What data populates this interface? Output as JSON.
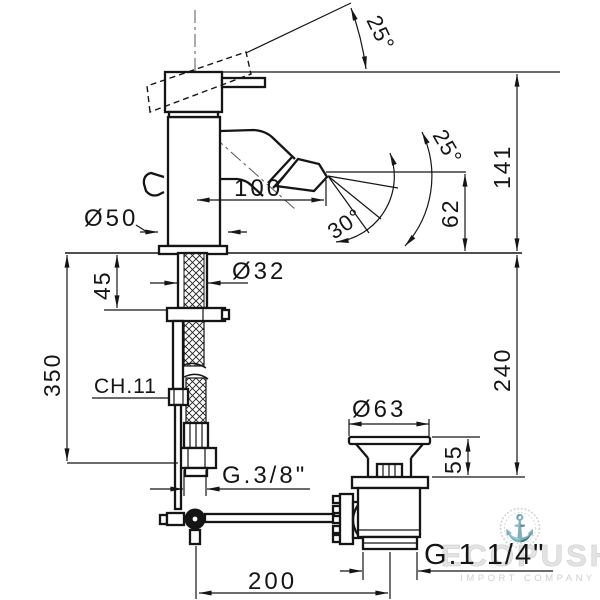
{
  "meta": {
    "background": "#ffffff",
    "ink_color": "#151515",
    "watermark_color": "#d8d8d8",
    "drawing_type": "bidet-mixer-dimensional-drawing"
  },
  "labels": {
    "handle_angle": "25°",
    "spout_height": "141",
    "spray_upper_angle": "25°",
    "spray_lower_angle": "30°",
    "spout_reach": "100",
    "spray_drop": "62",
    "base_diameter": "Ø50",
    "shank_diameter": "Ø32",
    "shank_length": "45",
    "hose_length": "350",
    "wrench_size": "CH.11",
    "under_counter_depth": "240",
    "waste_flange_diameter": "Ø63",
    "waste_height": "55",
    "supply_thread": "G.3/8\"",
    "waste_thread": "G.1 1/4\"",
    "rod_reach": "200"
  },
  "watermark": {
    "brand": "ECOPUSH",
    "subtitle": "IMPORT COMPANY",
    "icon": "anchor-icon",
    "anchor_glyph": "⚓"
  }
}
